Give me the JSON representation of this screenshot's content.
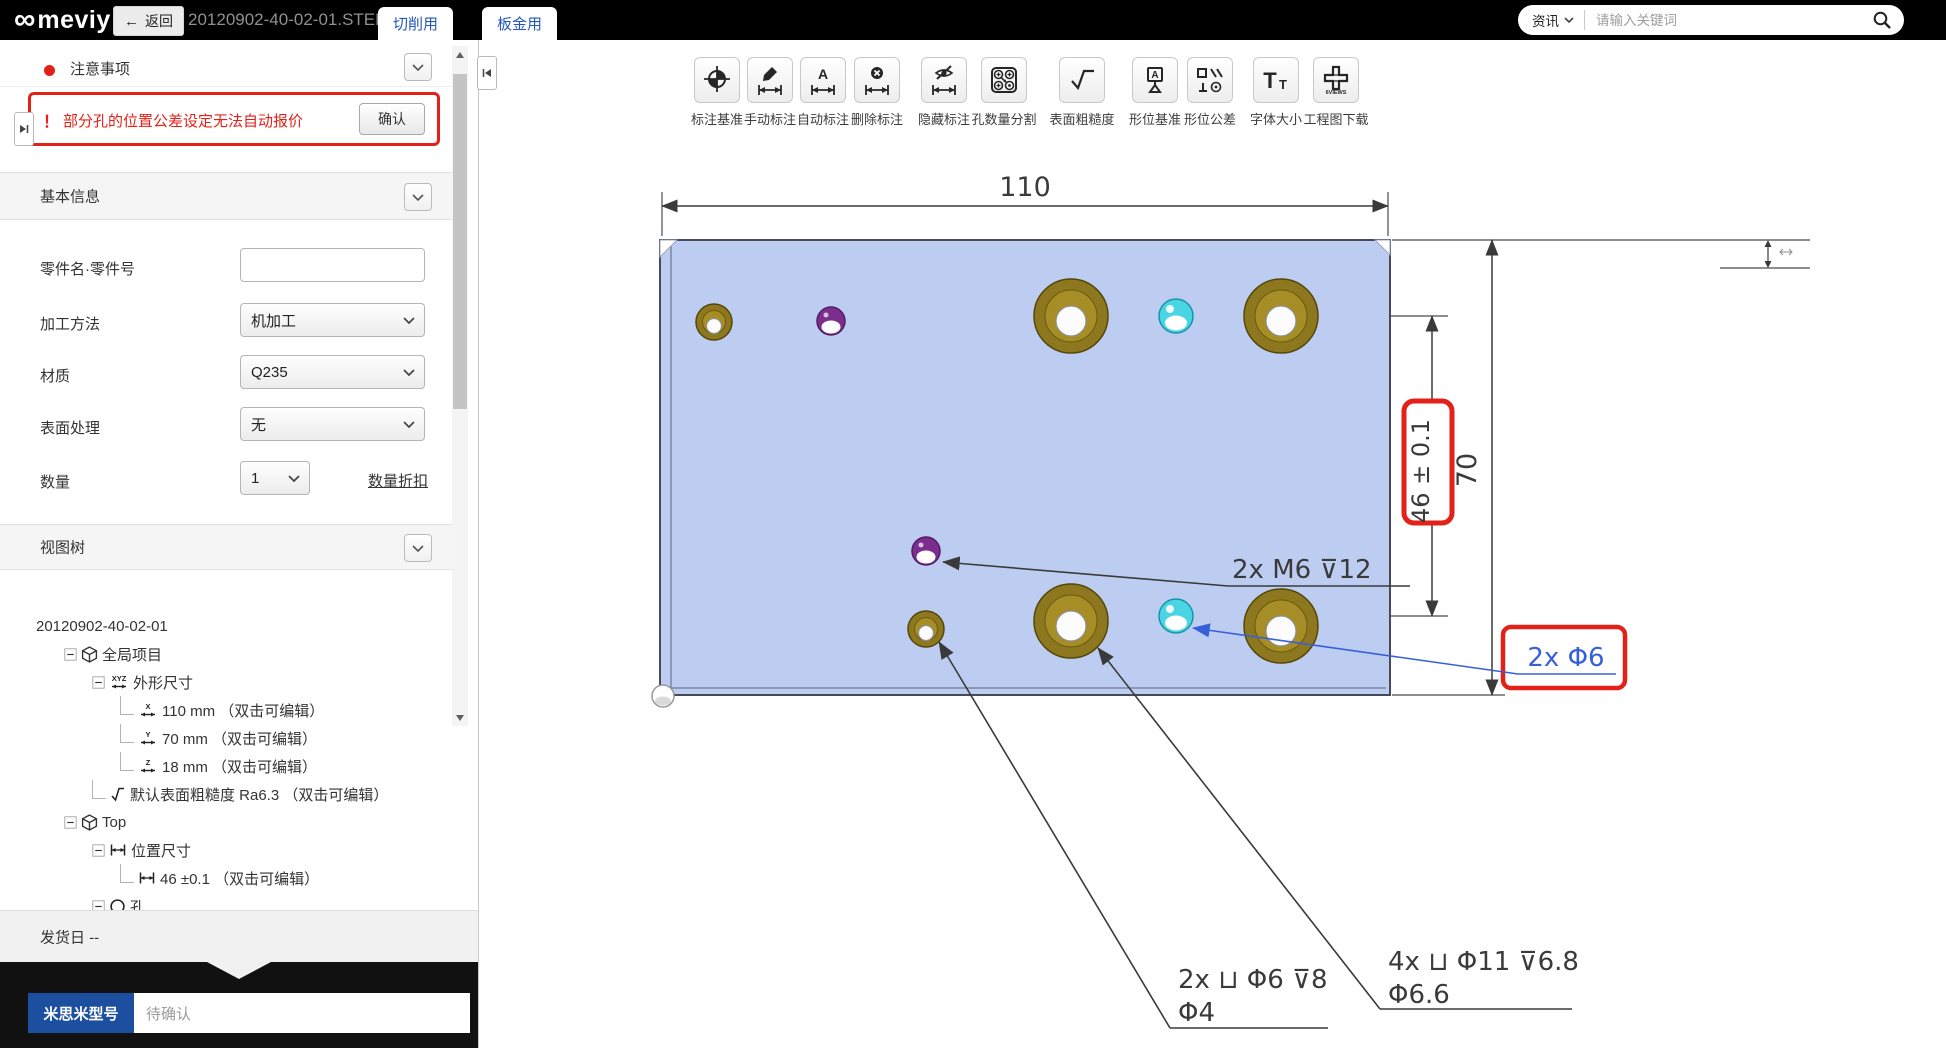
{
  "topbar": {
    "logo_mark": "∞",
    "logo_text": "meviy",
    "back_arrow": "←",
    "back_label": "返回",
    "filename": "20120902-40-02-01.STEP",
    "tabs": [
      {
        "label": "切削用"
      },
      {
        "label": "板金用"
      }
    ],
    "search": {
      "category": "资讯",
      "placeholder": "请输入关键词"
    }
  },
  "sidebar": {
    "notice": {
      "title": "注意事项",
      "warning_mark": "！",
      "warning_text": "部分孔的位置公差设定无法自动报价",
      "confirm_label": "确认"
    },
    "basic_info": {
      "title": "基本信息",
      "part_name_label": "零件名·零件号",
      "process_label": "加工方法",
      "process_value": "机加工",
      "material_label": "材质",
      "material_value": "Q235",
      "surface_label": "表面处理",
      "surface_value": "无",
      "qty_label": "数量",
      "qty_value": "1",
      "qty_discount_link": "数量折扣"
    },
    "view_tree": {
      "title": "视图树",
      "root_label": "20120902-40-02-01",
      "nodes": [
        {
          "label": "全局项目"
        },
        {
          "label": "外形尺寸",
          "axis": "XYZ"
        },
        {
          "label": "110 mm （双击可编辑）",
          "axis": "X"
        },
        {
          "label": "70 mm （双击可编辑）",
          "axis": "Y"
        },
        {
          "label": "18 mm （双击可编辑）",
          "axis": "Z"
        },
        {
          "label": "默认表面粗糙度 Ra6.3 （双击可编辑）"
        },
        {
          "label": "Top"
        },
        {
          "label": "位置尺寸"
        },
        {
          "label": "46 ±0.1 （双击可编辑）"
        },
        {
          "label": "孔"
        }
      ]
    },
    "shipping": {
      "label": "发货日",
      "value": "--"
    },
    "model": {
      "label": "米思米型号",
      "value": "待确认"
    }
  },
  "toolbar": {
    "buttons": [
      {
        "label": "标注基准"
      },
      {
        "label": "手动标注"
      },
      {
        "label": "自动标注",
        "glyph": "A"
      },
      {
        "label": "删除标注"
      },
      {
        "label": "隐藏标注"
      },
      {
        "label": "孔数量分割"
      },
      {
        "label": "表面粗糙度"
      },
      {
        "label": "形位基准",
        "glyph": "A"
      },
      {
        "label": "形位公差"
      },
      {
        "label": "字体大小",
        "glyph_large": "T",
        "glyph_small": "T"
      },
      {
        "label": "工程图下载",
        "glyph": "6VIEWS"
      }
    ]
  },
  "drawing": {
    "dims": {
      "width": "110",
      "height": "70",
      "position_tolerance": "46 ± 0.1"
    },
    "annotations": {
      "tap": "2x M6 ⊽12",
      "through": "2x Φ6",
      "cbore_small_1": "2x ⊔ Φ6 ⊽8",
      "cbore_small_2": "Φ4",
      "cbore_large_1": "4x ⊔ Φ11 ⊽6.8",
      "cbore_large_2": "Φ6.6"
    },
    "colors": {
      "plate": "#bdcdf2",
      "plate_edge": "#454b58",
      "counterbore_brass": "#8d7820",
      "tap_purple": "#7b2e8e",
      "hole_cyan": "#49d5e4",
      "highlight_red": "#e32119",
      "annotation_blue": "#3760d8"
    }
  }
}
